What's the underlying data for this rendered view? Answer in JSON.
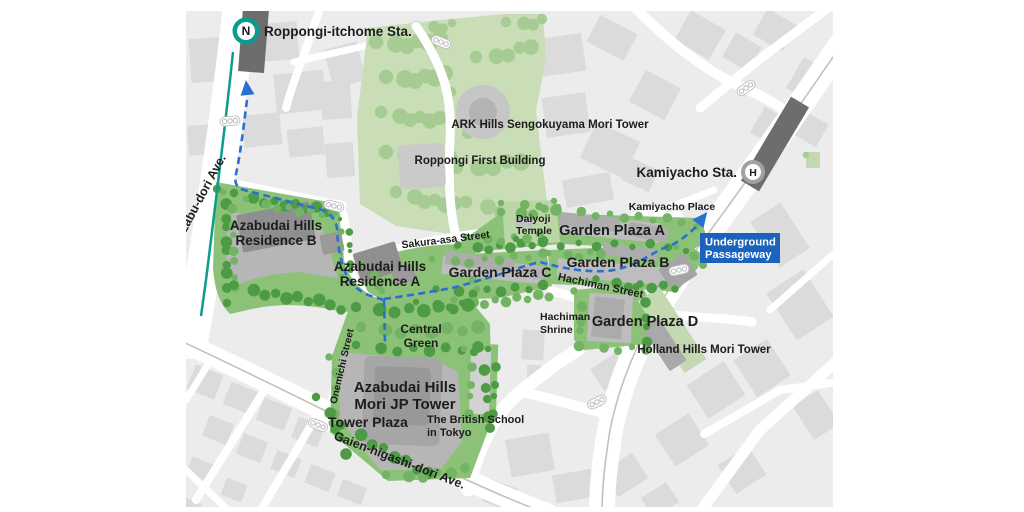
{
  "map": {
    "title": "Azabudai Hills access map",
    "stations": [
      {
        "id": "roppongi-itchome",
        "name": "Roppongi-itchome Sta.",
        "line_symbol": "N",
        "line_color": "#0c9c8d"
      },
      {
        "id": "kamiyacho",
        "name": "Kamiyacho Sta.",
        "line_symbol": "H",
        "line_color": "#9fa1a4"
      }
    ],
    "underground_passageway": {
      "line1": "Underground",
      "line2": "Passageway",
      "bg_color": "#1b62bd"
    },
    "streets": {
      "azabu_dori": "Azabu-dori Ave.",
      "sakura_asa": "Sakura-asa Street",
      "hachiman": "Hachiman Street",
      "onemichi": "Onemichi Street",
      "gaien_higashi": "Gaien-higashi-dori Ave."
    },
    "places": {
      "ark_hills": "ARK Hills Sengokuyama Mori Tower",
      "roppongi_first": "Roppongi First Building",
      "kamiyacho_place": "Kamiyacho Place",
      "residence_b": {
        "line1": "Azabudai Hills",
        "line2": "Residence B"
      },
      "residence_a": {
        "line1": "Azabudai Hills",
        "line2": "Residence A"
      },
      "daiyoji": {
        "line1": "Daiyoji",
        "line2": "Temple"
      },
      "garden_plaza_a": "Garden Plaza A",
      "garden_plaza_b": "Garden Plaza B",
      "garden_plaza_c": "Garden Plaza C",
      "garden_plaza_d": "Garden Plaza D",
      "hachiman_shrine": {
        "line1": "Hachiman",
        "line2": "Shrine"
      },
      "holland_hills": "Holland Hills Mori Tower",
      "central_green": {
        "line1": "Central",
        "line2": "Green"
      },
      "mori_jp": {
        "line1": "Azabudai Hills",
        "line2": "Mori JP Tower"
      },
      "tower_plaza": "Tower Plaza",
      "british_school": {
        "line1": "The British School",
        "line2": "in Tokyo"
      }
    },
    "colors": {
      "map_bg": "#ececec",
      "road": "#ffffff",
      "building": "#dbdbdb",
      "park_green": "#c9ddb6",
      "site_green": "#8cc178",
      "platform_gray": "#b6b6b6",
      "dark_building": "#8f8f8f",
      "station_bar": "#6d6d6d",
      "walk_route": "#2a6fd2",
      "namboku_teal": "#0c9c8d",
      "hibiya_silver": "#9fa1a4",
      "passage_blue": "#1b62bd",
      "label_text": "#1c1c1c"
    }
  }
}
